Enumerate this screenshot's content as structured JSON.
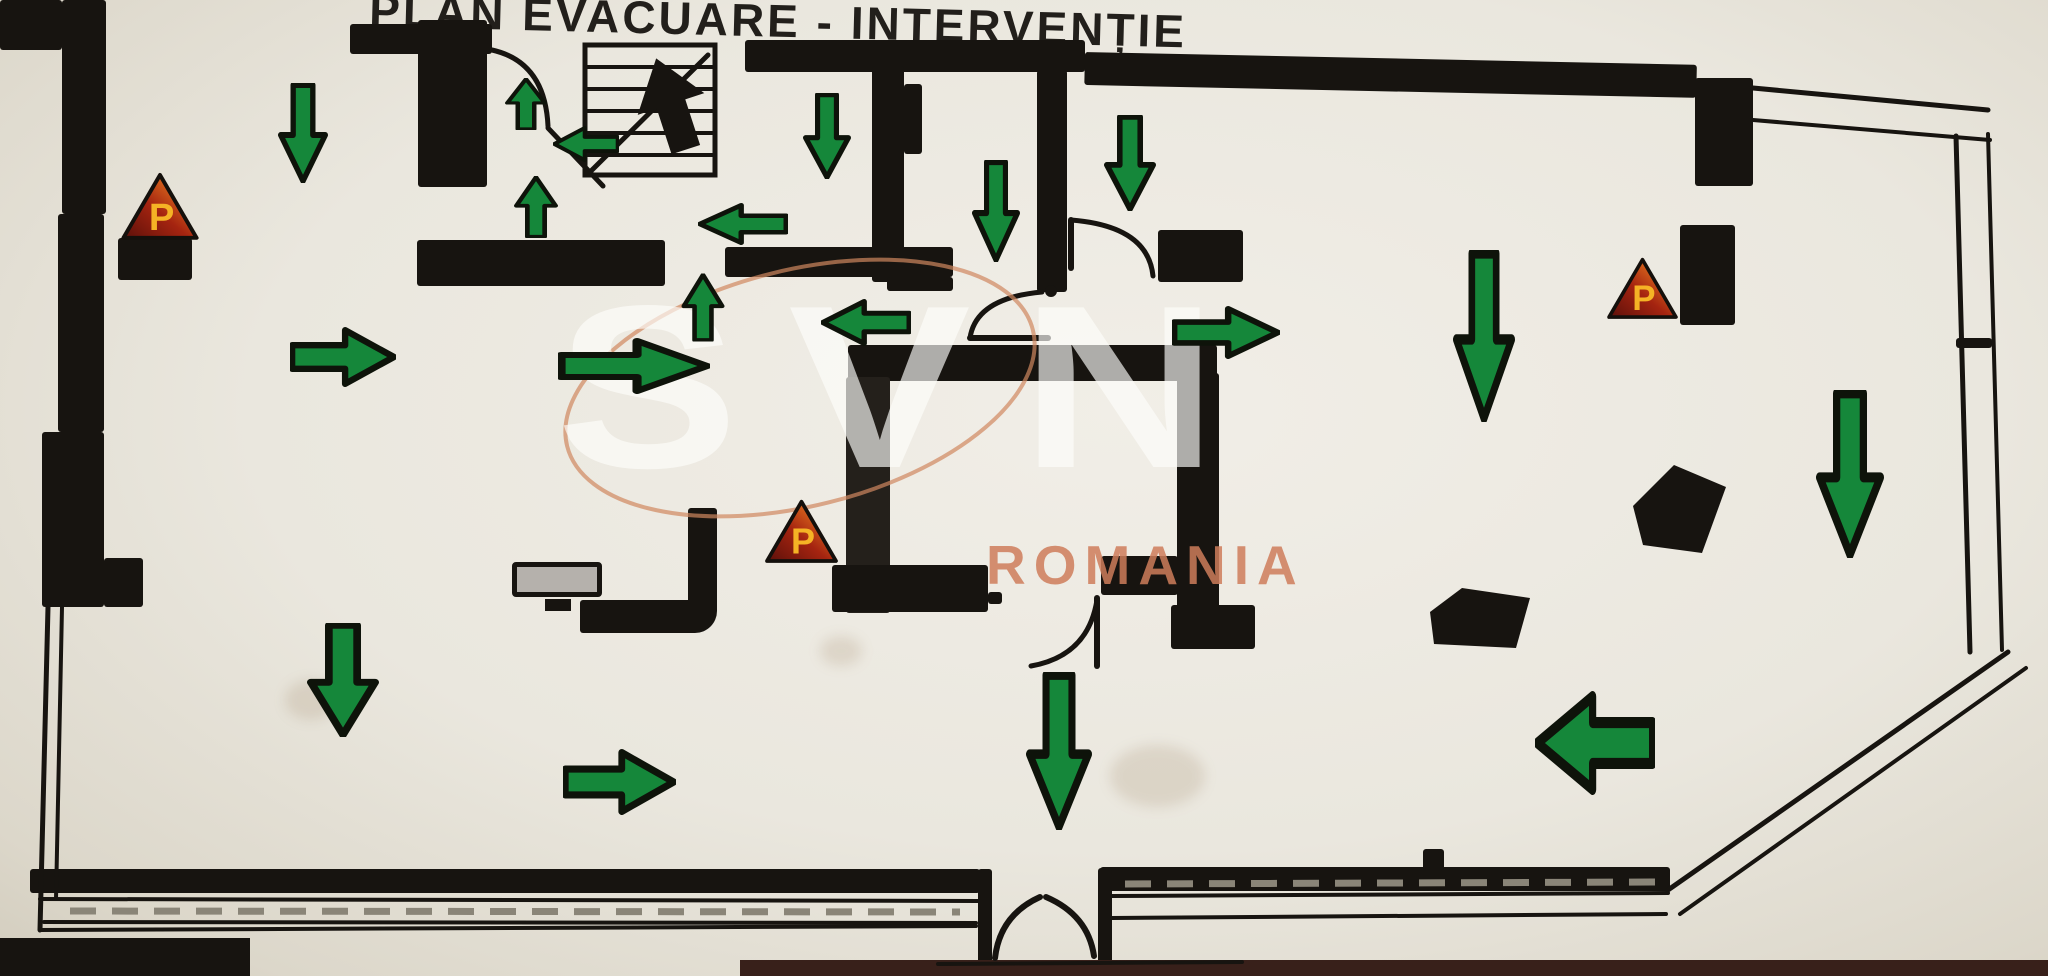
{
  "title": {
    "text": "PLAN EVACUARE - INTERVENȚIE"
  },
  "watermark": {
    "brand": "SVN",
    "country": "ROMANIA"
  },
  "extinguisher": {
    "symbol": "P"
  },
  "colors": {
    "paper": "#eae7de",
    "wall": "#171410",
    "arrow_green": "#15873a",
    "arrow_outline": "#0e130a",
    "triangle_dark_red": "#5c100a",
    "triangle_red": "#a52410",
    "triangle_orange": "#e0701e",
    "letter_orange": "#f5b325",
    "watermark_swoosh": "#d0875f"
  },
  "extinguishers": [
    {
      "x": 118,
      "y": 171,
      "w": 84,
      "h": 70
    },
    {
      "x": 763,
      "y": 498,
      "w": 77,
      "h": 66
    },
    {
      "x": 1606,
      "y": 256,
      "w": 73,
      "h": 64
    }
  ],
  "arrows": [
    {
      "dir": "down",
      "x": 278,
      "y": 83,
      "w": 50,
      "h": 100
    },
    {
      "dir": "up",
      "x": 505,
      "y": 78,
      "w": 42,
      "h": 52
    },
    {
      "dir": "left",
      "x": 553,
      "y": 126,
      "w": 66,
      "h": 36
    },
    {
      "dir": "up",
      "x": 514,
      "y": 176,
      "w": 44,
      "h": 62
    },
    {
      "dir": "left",
      "x": 698,
      "y": 203,
      "w": 90,
      "h": 42
    },
    {
      "dir": "down",
      "x": 803,
      "y": 93,
      "w": 48,
      "h": 86
    },
    {
      "dir": "down",
      "x": 972,
      "y": 160,
      "w": 48,
      "h": 102
    },
    {
      "dir": "down",
      "x": 1104,
      "y": 115,
      "w": 52,
      "h": 96
    },
    {
      "dir": "up",
      "x": 681,
      "y": 273,
      "w": 43,
      "h": 68
    },
    {
      "dir": "left",
      "x": 821,
      "y": 299,
      "w": 90,
      "h": 47
    },
    {
      "dir": "right",
      "x": 558,
      "y": 338,
      "w": 152,
      "h": 56
    },
    {
      "dir": "right",
      "x": 1172,
      "y": 306,
      "w": 108,
      "h": 53
    },
    {
      "dir": "right",
      "x": 290,
      "y": 327,
      "w": 106,
      "h": 60
    },
    {
      "dir": "down",
      "x": 1453,
      "y": 250,
      "w": 62,
      "h": 172
    },
    {
      "dir": "down",
      "x": 1816,
      "y": 390,
      "w": 68,
      "h": 168
    },
    {
      "dir": "down",
      "x": 307,
      "y": 623,
      "w": 72,
      "h": 114
    },
    {
      "dir": "right",
      "x": 563,
      "y": 749,
      "w": 113,
      "h": 66
    },
    {
      "dir": "down",
      "x": 1026,
      "y": 672,
      "w": 66,
      "h": 158
    },
    {
      "dir": "left",
      "x": 1535,
      "y": 691,
      "w": 120,
      "h": 104
    }
  ]
}
